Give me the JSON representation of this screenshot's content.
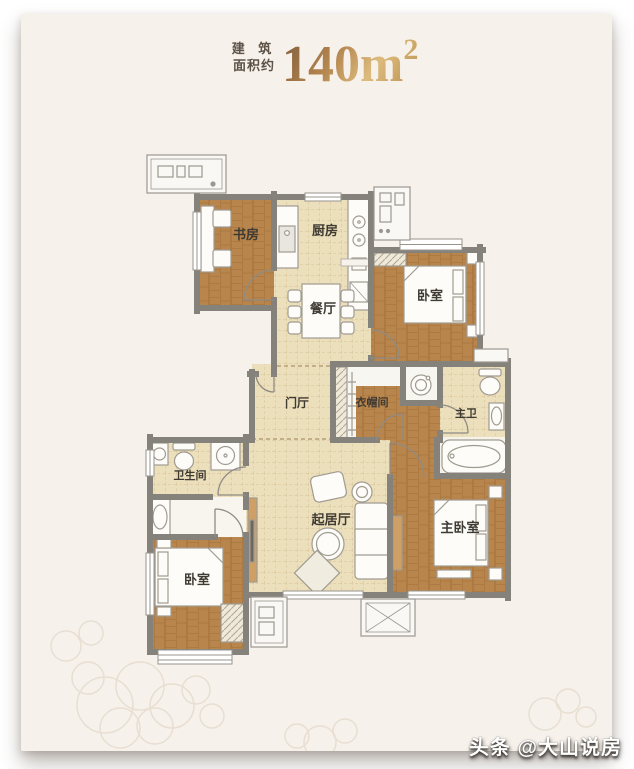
{
  "title": {
    "line1": "建 筑",
    "line2": "面积约",
    "area_value": "140m",
    "area_sup": "2"
  },
  "watermark": {
    "text": "头条 @大山说房"
  },
  "floorplan": {
    "type": "apartment-floor-plan",
    "area_label": "建筑面积约140m²",
    "rooms": [
      {
        "id": "study",
        "label": "书房"
      },
      {
        "id": "kitchen",
        "label": "厨房"
      },
      {
        "id": "dining",
        "label": "餐厅"
      },
      {
        "id": "bedroom-north",
        "label": "卧室"
      },
      {
        "id": "foyer",
        "label": "门厅"
      },
      {
        "id": "cloakroom",
        "label": "衣帽间"
      },
      {
        "id": "master-bath",
        "label": "主卫"
      },
      {
        "id": "bathroom",
        "label": "卫生间"
      },
      {
        "id": "living-room",
        "label": "起居厅"
      },
      {
        "id": "master-bedroom",
        "label": "主卧室"
      },
      {
        "id": "bedroom-south",
        "label": "卧室"
      }
    ],
    "colors": {
      "card_bg": "#f6f1ea",
      "wall": "#85827c",
      "wood_floor": "#b8854c",
      "tile_floor": "#ecdfbc",
      "label_text": "#3f3b33",
      "title_gold": "#b3854f",
      "title_small_text": "#5d5348"
    }
  }
}
